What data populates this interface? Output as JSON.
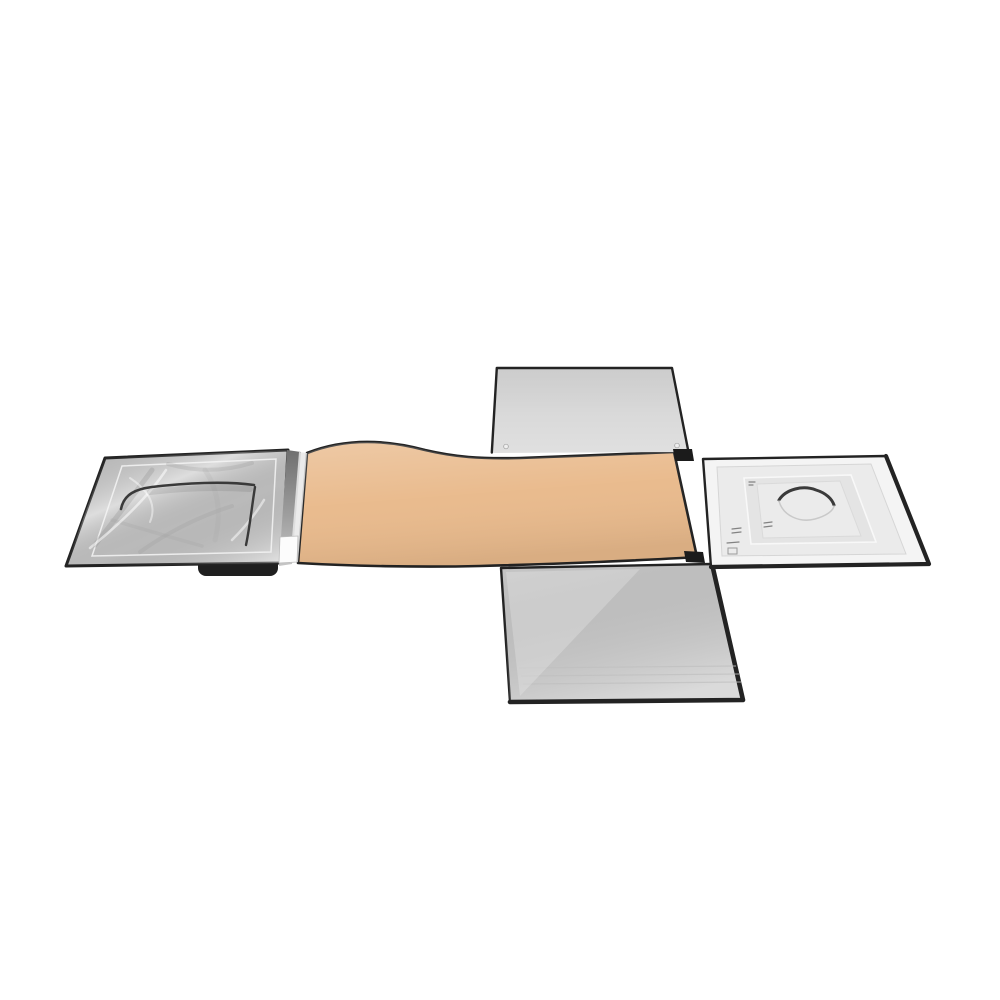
{
  "scene": {
    "title": "Flat-lay product photo of an unfolded collapsible photo light tent / softbox, opened into a cross shape on a white background",
    "background_description": "pure white seamless background",
    "parts": [
      {
        "name": "left-reflector-panel",
        "description": "silver crinkled reflective panel with curved flap cut and black trim"
      },
      {
        "name": "hinge-strip",
        "description": "folded edge strip with small white label tag joining silver panel to base"
      },
      {
        "name": "center-base-panel",
        "description": "tan / beige fabric base band with black piping and two black corner tabs"
      },
      {
        "name": "top-diffuser-panel",
        "description": "light gray diffuser side panel folded upward"
      },
      {
        "name": "bottom-diffuser-panel",
        "description": "light gray diffuser side panel folded downward with black piping"
      },
      {
        "name": "right-lid-panel",
        "description": "white lid panel with embossed square, camera-lens arc opening and small snap marks"
      },
      {
        "name": "rubber-foot",
        "description": "small black rubber bumper under left panel edge"
      }
    ]
  },
  "colors": {
    "background": "#ffffff",
    "trim-black": "#232323",
    "tan": "#e9ba8c",
    "tan-shadow": "#dfa97a",
    "panel-gray": "#d7d7d7",
    "panel-gray-deep": "#cccccc",
    "silver": "#cfcfcf",
    "silver-highlight": "#f2f2f2",
    "silver-shadow": "#9c9c9c",
    "white-panel": "#f4f4f4",
    "inner-gray": "#ebebeb",
    "mark-dark": "#3a3a3a",
    "tag-white": "#fcfcfc"
  }
}
